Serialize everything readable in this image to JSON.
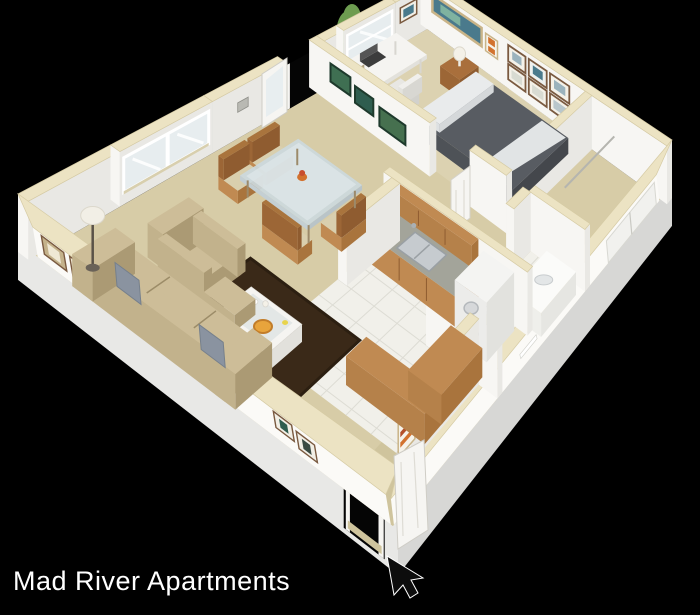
{
  "title": "Mad River Apartments",
  "icons": {
    "cursor": "mouse-pointer-arrow",
    "tree": "evergreen-shrub"
  },
  "palette": {
    "bg": "#000000",
    "titleColor": "#ffffff",
    "wallFace": "#f7f6f3",
    "wallShade": "#e9e8e4",
    "wallBand": "#fbfaf7",
    "trimTop": "#ece3c3",
    "trimEdge": "#d6cba4",
    "extLight": "#e3e3e1",
    "extDark": "#cmc",
    "extSW": "#e8e8e6",
    "extSE": "#d7d7d5",
    "carpet": "#d7cca7",
    "carpetBedroom": "#dcd2b1",
    "carpetEntry": "#cfc49d",
    "tile": "#f1f0ea",
    "tileLine": "#dddcd4",
    "rug": "#3a2918",
    "rugEdge": "#2c1f11",
    "wood": "#c08a52",
    "woodDark": "#a9743d",
    "counterTop": "#a3a49a",
    "steel": "#c6cbcf",
    "applianceWhite": "#f4f4f2",
    "furnWhite": "#f5f4f1",
    "furnWhiteShade": "#e2e1dc",
    "glassTop": "#ccd9dd",
    "sofa": "#c2b28c",
    "sofaShade": "#ab9a74",
    "sofaTop": "#cdbd98",
    "pillow": "#8a93a0",
    "duvet": "#585c62",
    "duvetShade": "#44474c",
    "sheet": "#e9ebec",
    "nightstand": "#a96f3c",
    "treeDark": "#3d6130",
    "treeMid": "#517f3b",
    "treeLight": "#6d9c50",
    "trunk": "#6e4f2f",
    "artBlue": "#4a7a8c",
    "artGreen": "#3f6f52",
    "artTeal": "#2f5d4f",
    "artOrange": "#d2722e",
    "frameTan": "#c4b28b",
    "frameDark": "#7a5a40",
    "doorWhite": "#f6f5f2",
    "glassDoor": "#e7edef",
    "outside": "#050505",
    "cursorFill": "#0d0d0d"
  },
  "scene": {
    "type": "3d-isometric-floor-plan",
    "unit": "one-bedroom-apartment",
    "rooms": [
      {
        "name": "living-room",
        "furniture": [
          "sofa",
          "throw-pillows",
          "armchair",
          "ottoman",
          "coffee-table",
          "pizza",
          "area-rug",
          "floor-lamp",
          "gallery-frames",
          "double-window",
          "glass-entry-door",
          "thermostat"
        ]
      },
      {
        "name": "dining-area",
        "furniture": [
          "glass-dining-table",
          "dining-chairs",
          "flower-centerpiece",
          "landscape-art"
        ]
      },
      {
        "name": "bedroom",
        "furniture": [
          "bed",
          "pillow",
          "nightstand",
          "table-lamp",
          "desk",
          "laptop",
          "books",
          "office-chair",
          "window",
          "panorama-art",
          "frame-grid-art"
        ]
      },
      {
        "name": "walk-in-closet",
        "furniture": [
          "sliding-door"
        ]
      },
      {
        "name": "bathroom",
        "furniture": [
          "vanity",
          "toilet",
          "towel-bar",
          "paneled-door"
        ]
      },
      {
        "name": "kitchen",
        "furniture": [
          "upper-cabinets",
          "base-cabinets",
          "sink",
          "faucet",
          "washer-dryer-stack",
          "breakfast-bar",
          "tile-floor"
        ]
      },
      {
        "name": "entry-hall",
        "furniture": [
          "front-door",
          "wall-art-orange"
        ]
      }
    ],
    "exterior": [
      "shrub-tree",
      "cursor-arrow"
    ]
  }
}
